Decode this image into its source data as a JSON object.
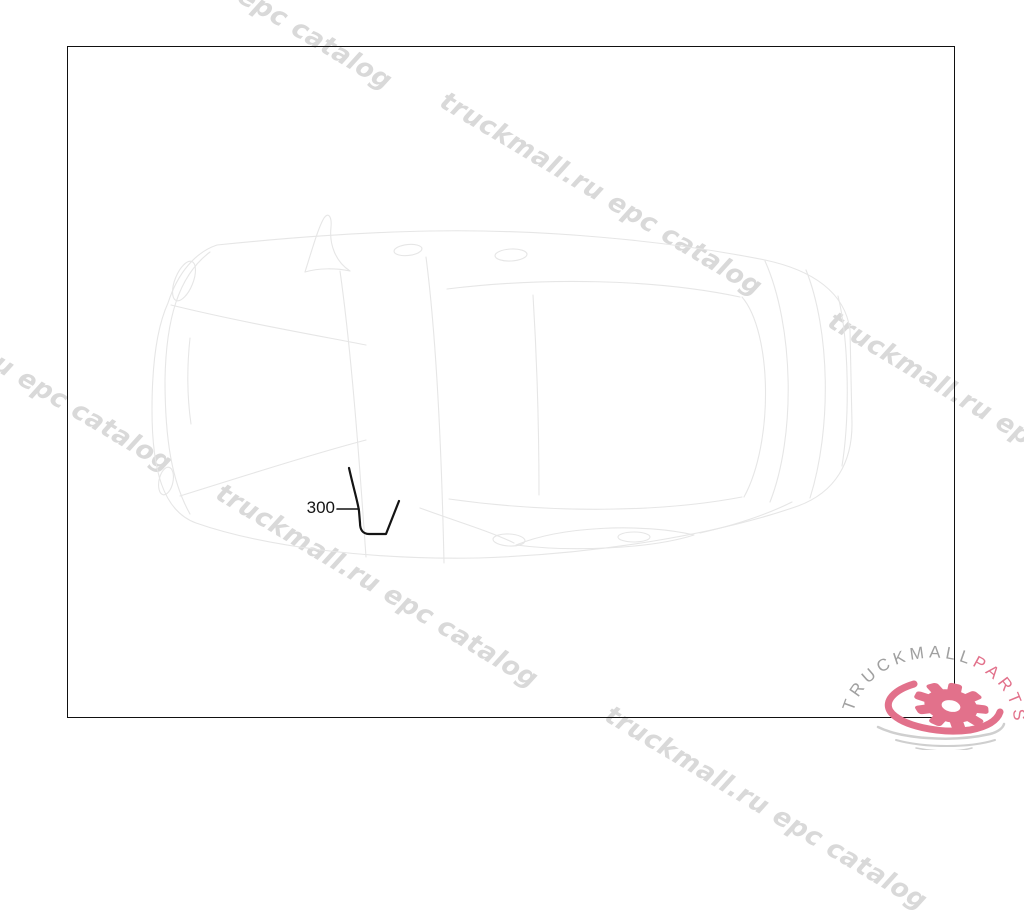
{
  "page": {
    "background": "#ffffff",
    "width": 1024,
    "height": 750
  },
  "diagram": {
    "type": "vehicle-top-view-parts-diagram",
    "part_callouts": [
      {
        "label": "300"
      }
    ]
  },
  "watermark": {
    "text": "truckmall.ru epc catalog",
    "color": "#d9d9d9"
  },
  "logo": {
    "brand_gray": "TRUCKMALL",
    "brand_pink": "PARTS",
    "gray_color": "#a0a0a0",
    "pink_color": "#e2718b"
  },
  "colors": {
    "frame_border": "#111111",
    "part_line": "#141414",
    "car_sketch": "#e6e6e6",
    "ripple_gray": "#cfcfcf"
  }
}
